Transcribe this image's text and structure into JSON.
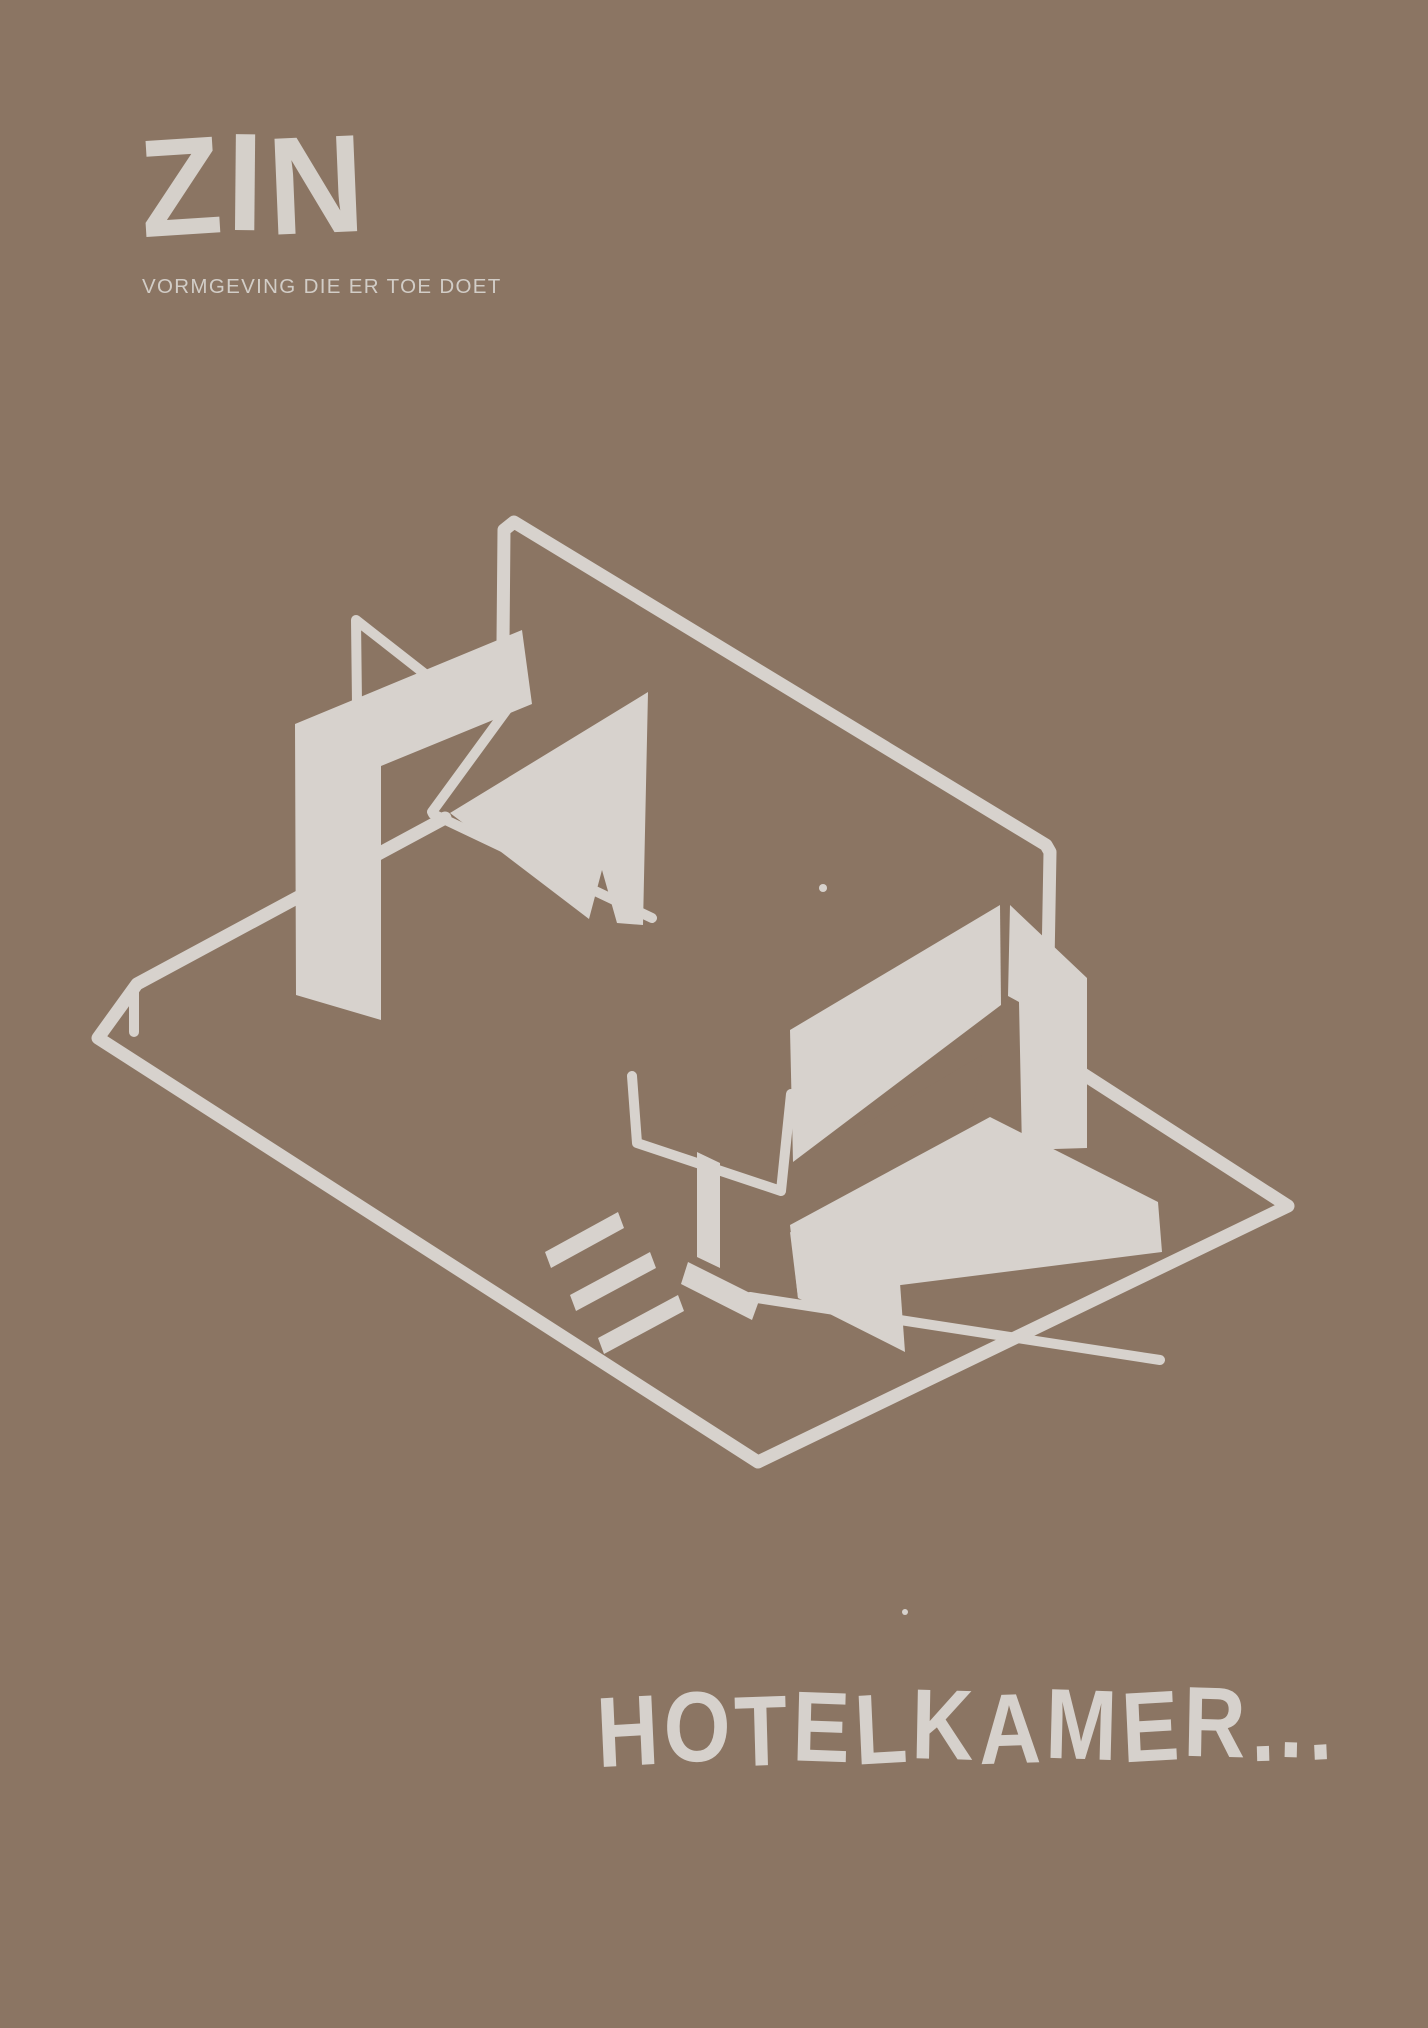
{
  "poster": {
    "background_color": "#8B7563",
    "ink_color": "#D7D2CD"
  },
  "logo": {
    "text": "ZIN",
    "tagline": "VORMGEVING DIE ER TOE DOET"
  },
  "caption": {
    "text": "HOTELKAMER..."
  }
}
